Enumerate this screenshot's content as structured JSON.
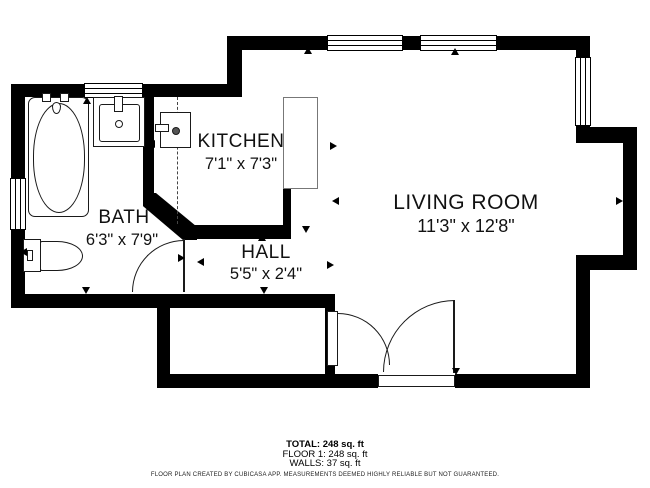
{
  "plan": {
    "title": "Floor plan",
    "rooms": [
      {
        "name": "KITCHEN",
        "dimensions": "7'1\" x 7'3\""
      },
      {
        "name": "LIVING ROOM",
        "dimensions": "11'3\" x 12'8\""
      },
      {
        "name": "BATH",
        "dimensions": "6'3\" x 7'9\""
      },
      {
        "name": "HALL",
        "dimensions": "5'5\" x 2'4\""
      }
    ],
    "summary": {
      "total": "TOTAL: 248 sq. ft",
      "floor1": "FLOOR 1: 248 sq. ft",
      "walls": "WALLS: 37 sq. ft"
    },
    "disclaimer": "FLOOR PLAN CREATED BY CUBICASA APP. MEASUREMENTS DEEMED HIGHLY RELIABLE BUT NOT GUARANTEED.",
    "colors": {
      "wall": "#000000",
      "floor": "#ffffff",
      "counter_outline": "#777777",
      "text": "#111111"
    }
  }
}
